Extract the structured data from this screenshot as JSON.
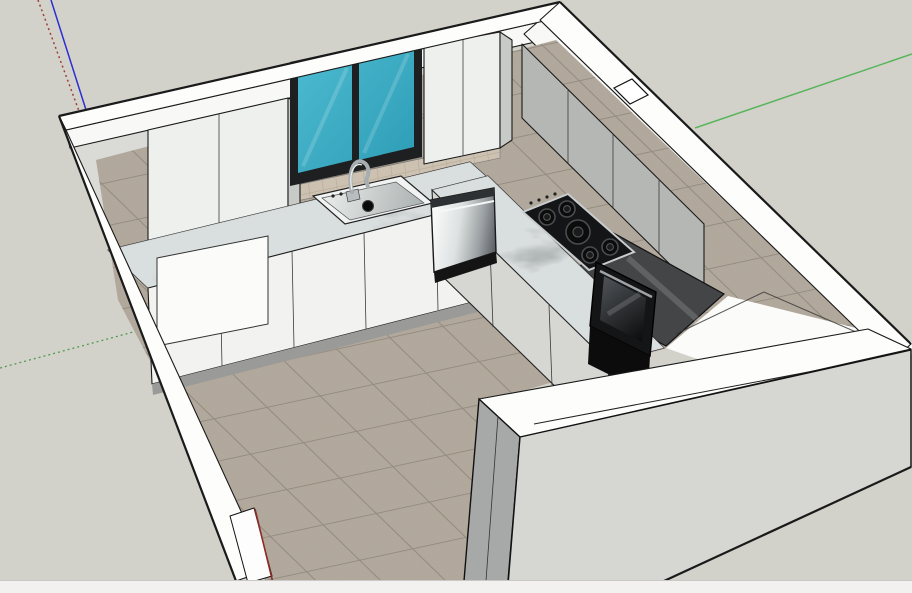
{
  "viewport": {
    "kind": "3d-model-viewport",
    "description": "doll-house style 3d view of a U-shaped kitchen model seen from above",
    "background": "#d2d2cb"
  },
  "status_bar": {
    "text": "",
    "background": "#f2f1ef",
    "border": "#c9c8c5"
  },
  "axes": {
    "blue_solid": "#2e2ed2",
    "red_dotted": "#9e4038",
    "green_solid": "#58b55a",
    "green_dotted": "#4f9b4f",
    "red_solid": "#8c2d26"
  },
  "colors": {
    "bg": "#d2d2cb",
    "edge": "#1a1a1a",
    "bar_bg": "#f2f1ef",
    "bar_border": "#c9c8c5",
    "wall_top": "#fdfdfc",
    "wall_band": "#f8f8f6",
    "inner_face": "#dadbd6",
    "jamb": "#a7a9a8",
    "jamb_dark": "#949694",
    "front_face": "#d6d7d2",
    "cab_white": "#eef0ee",
    "cab_side": "#c8cac7",
    "cab_gray": "#b5b7b4",
    "base_white": "#f2f3f1",
    "end_panel": "#fbfbfa",
    "kick": "#9a9b98",
    "splash_tile": "#cdc2b1",
    "splash_grout": "#b6aa98",
    "floor_tile": "#b2a89c",
    "floor_grout": "#91887b",
    "glass_a": "#4ab8ce",
    "glass_b": "#2c9cb5",
    "window_frame": "#1d1f20",
    "marble_base": "#8e9595",
    "steel_light": "#f8f9f9",
    "steel_dark": "#5b6165",
    "appliance_black": "#141517",
    "oven_top": "#434547",
    "sink_rim": "#f1f3f2",
    "chrome": "#a7adb0"
  },
  "scene": {
    "objects": [
      {
        "label": "room-walls-white-cutaway"
      },
      {
        "label": "window-two-teal-panes"
      },
      {
        "label": "upper-cabinets"
      },
      {
        "label": "marble-countertops"
      },
      {
        "label": "kitchen-sink-with-faucet"
      },
      {
        "label": "stainless-dishwasher"
      },
      {
        "label": "gas-cooktop-5-burners"
      },
      {
        "label": "built-in-black-oven"
      },
      {
        "label": "beige-tile-floor"
      },
      {
        "label": "drawing-axes-rgb"
      }
    ]
  }
}
